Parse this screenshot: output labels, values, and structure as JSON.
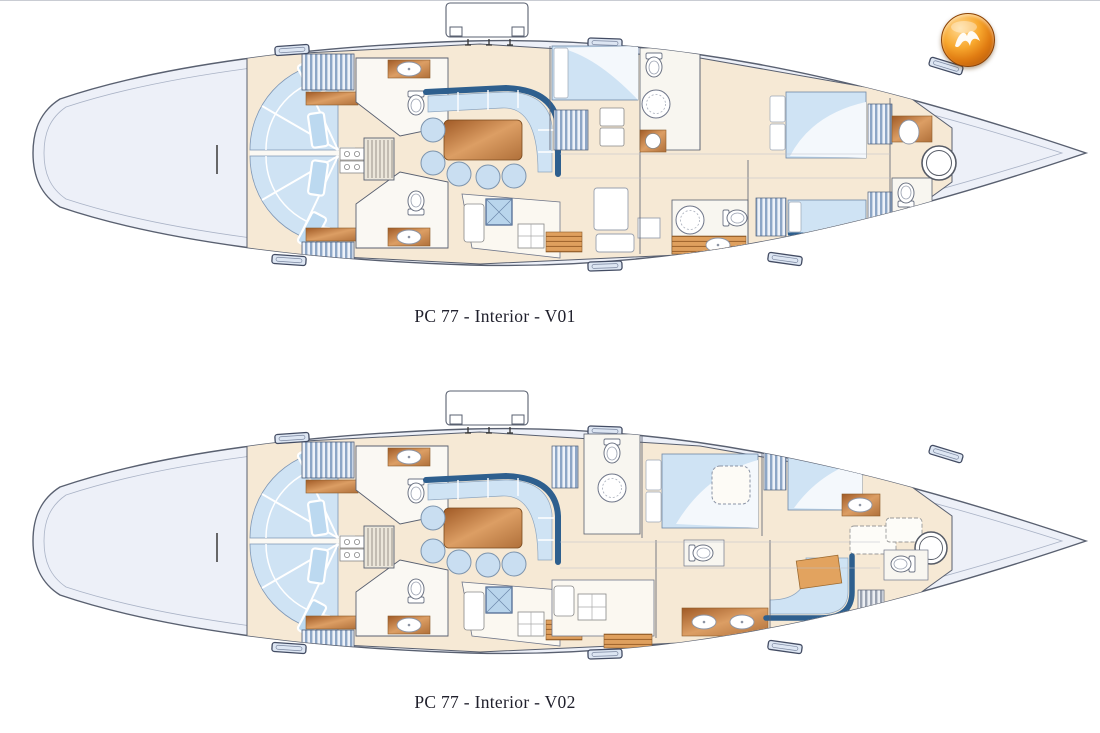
{
  "document": {
    "type": "yacht-interior-plan-sheet",
    "figures": [
      {
        "name": "interior-plan-v01",
        "caption": "PC 77 - Interior - V01"
      },
      {
        "name": "interior-plan-v02",
        "caption": "PC 77 - Interior - V02"
      }
    ],
    "logo": {
      "name": "brand-logo",
      "description": "glossy orange sphere with white swoosh",
      "color_outer": "#a64a06",
      "color_mid": "#f8a82e",
      "color_highlight": "#ffd992",
      "glyph_color": "#ffffff"
    },
    "palette": {
      "page_background": "#ffffff",
      "hull_fill": "#edf0f8",
      "hull_line": "#596070",
      "interior_floor": "#f6e9d5",
      "upholstery_blue": "#cfe3f4",
      "accent_blue": "#2e5f8e",
      "wood_light": "#dc9e64",
      "wood_dark": "#a05a26",
      "locker_stripe": "#8da6c6",
      "fixture_white": "#ffffff"
    }
  }
}
